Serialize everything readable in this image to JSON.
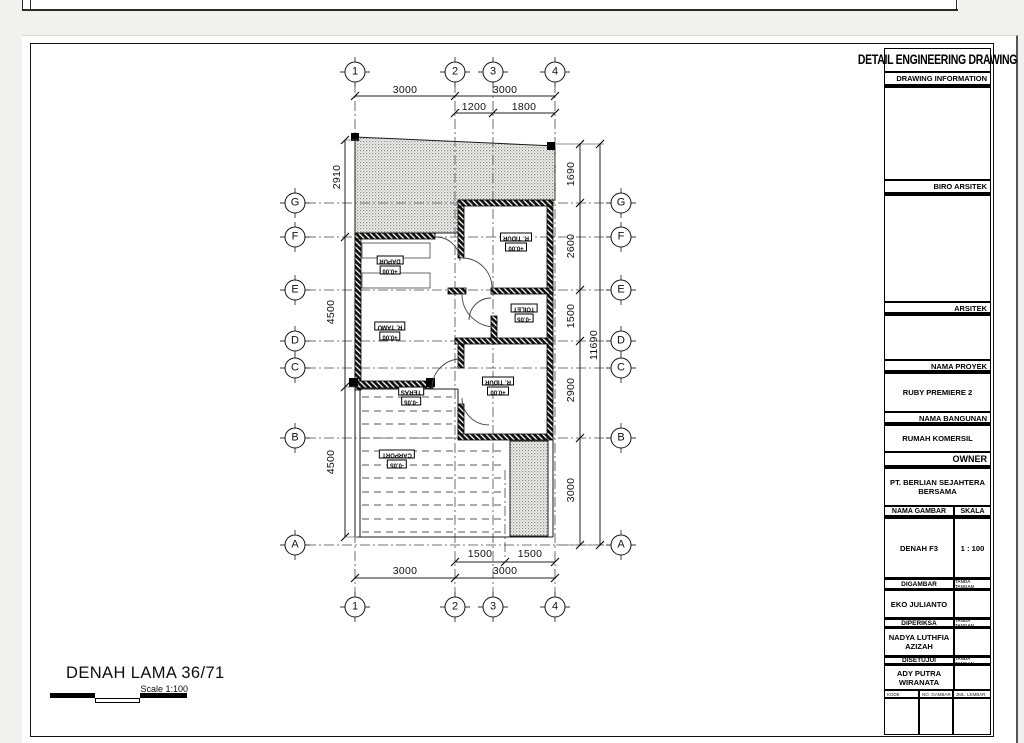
{
  "title_block": {
    "header": "DETAIL ENGINEERING DRAWING",
    "drawing_information_label": "DRAWING INFORMATION",
    "biro_arsitek_label": "BIRO ARSITEK",
    "arsitek_label": "ARSITEK",
    "nama_proyek_label": "NAMA PROYEK",
    "nama_proyek_value": "RUBY PREMIERE 2",
    "nama_bangunan_label": "NAMA BANGUNAN",
    "nama_bangunan_value": "RUMAH KOMERSIL",
    "owner_label": "OWNER",
    "owner_value": "PT. BERLIAN SEJAHTERA BERSAMA",
    "nama_gambar_label": "NAMA GAMBAR",
    "skala_label": "SKALA",
    "nama_gambar_value": "DENAH F3",
    "skala_value": "1 : 100",
    "digambar_label": "DIGAMBAR",
    "digambar_value": "EKO JULIANTO",
    "diperiksa_label": "DIPERIKSA",
    "diperiksa_value": "NADYA LUTHFIA AZIZAH",
    "disetujui_label": "DISETUJUI",
    "disetujui_value": "ADY PUTRA WIRANATA",
    "tanda_tangan_label": "TANDA TANGAN",
    "footer": {
      "kode_gambar_label": "KODE GAMBAR",
      "no_gambar_label": "NO. GAMBAR",
      "jml_lembar_label": "JML. LEMBAR"
    }
  },
  "plan": {
    "title": "DENAH LAMA 36/71",
    "scale_text": "Scale 1:100",
    "grid_cols": [
      "1",
      "2",
      "3",
      "4"
    ],
    "grid_rows": [
      "G",
      "F",
      "E",
      "D",
      "C",
      "B",
      "A"
    ],
    "dims": {
      "top_row1": [
        "3000",
        "3000"
      ],
      "top_row2": [
        "1200",
        "1800"
      ],
      "bottom_row1": [
        "1500",
        "1500"
      ],
      "bottom_row2": [
        "3000",
        "3000"
      ],
      "left": [
        "2910",
        "4500",
        "4500"
      ],
      "right": [
        "1690",
        "2600",
        "1500",
        "2900",
        "3000"
      ],
      "right_total": "11690"
    },
    "rooms": [
      {
        "name": "DAPUR",
        "level": "+0.00"
      },
      {
        "name": "R. TIDUR",
        "level": "+0.00"
      },
      {
        "name": "R. TAMU",
        "level": "+0.00"
      },
      {
        "name": "TOILET",
        "level": "-0.05"
      },
      {
        "name": "R. TIDUR",
        "level": "+0.00"
      },
      {
        "name": "TERAS",
        "level": "-0.05"
      },
      {
        "name": "CARPORT",
        "level": "-0.05"
      }
    ]
  },
  "colors": {
    "paper": "#ffffff",
    "background": "#f1f1ee",
    "line": "#1a1a1a"
  }
}
